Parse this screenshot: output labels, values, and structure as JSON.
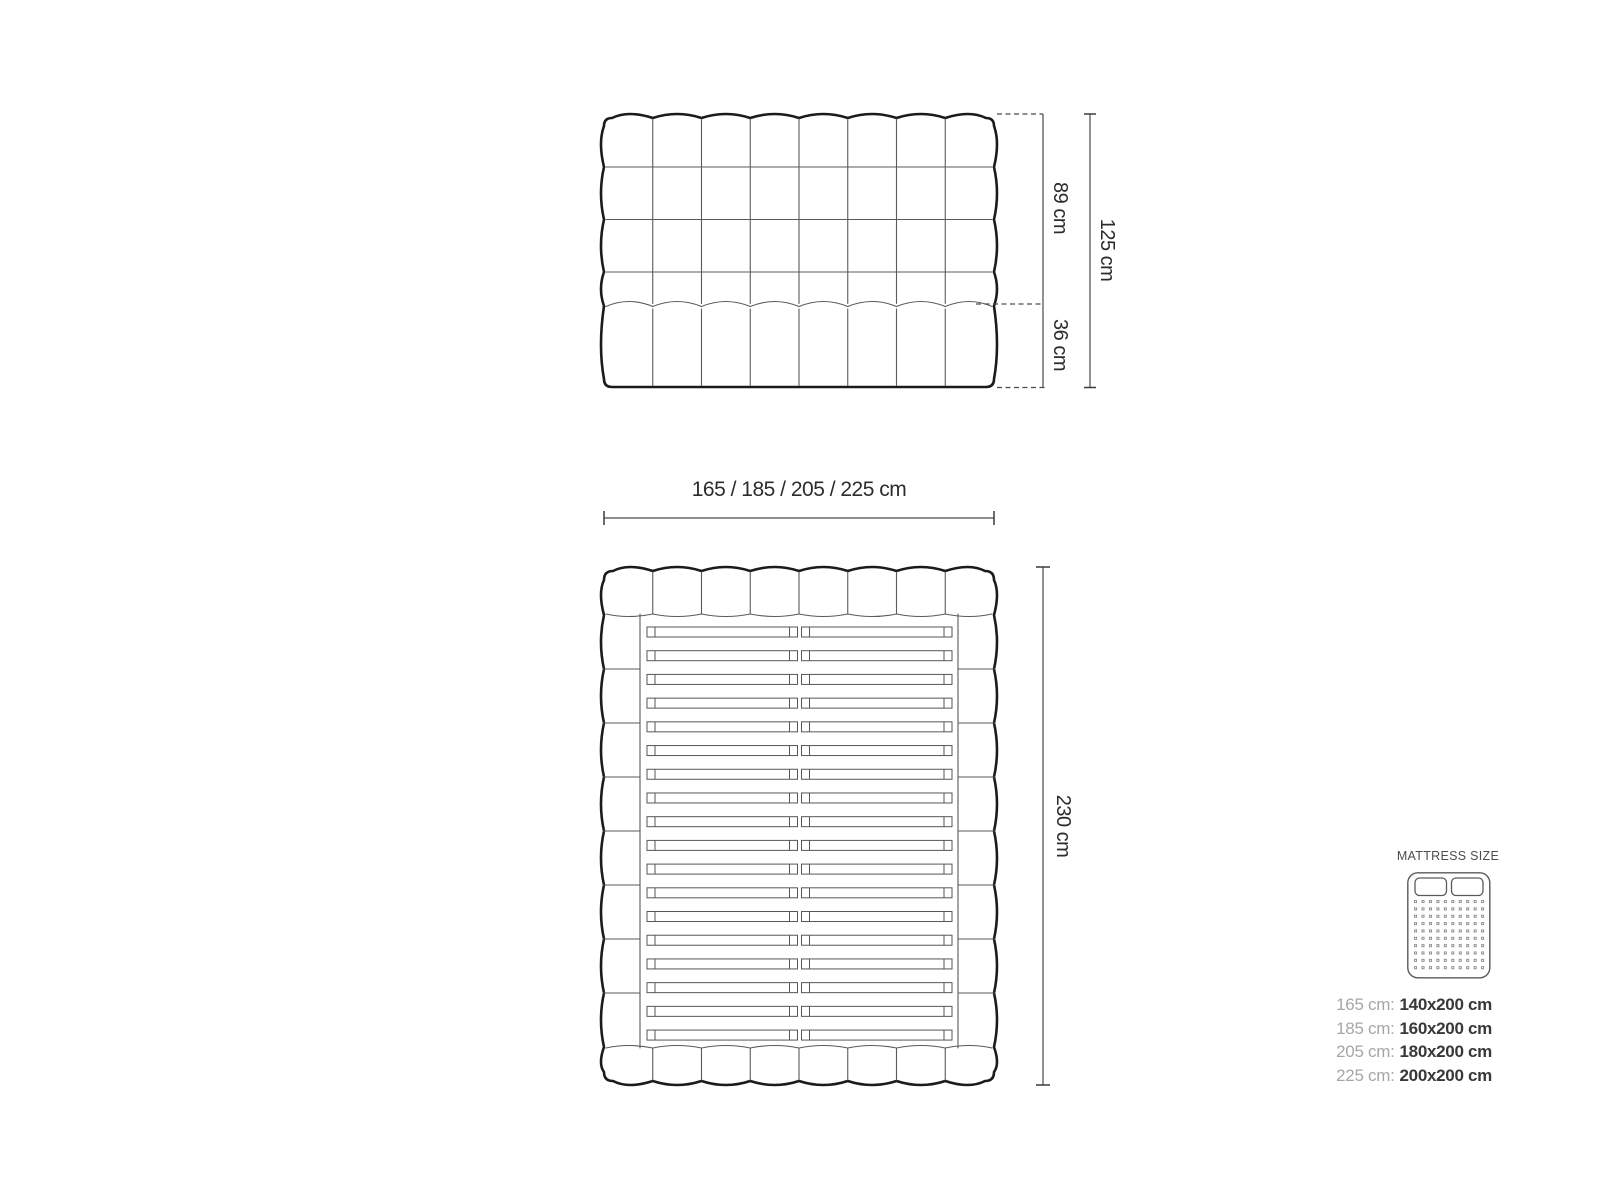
{
  "figure": {
    "type": "bed-dimension-diagram",
    "headboard_front": {
      "columns": 8,
      "tuft_rows_upper": 4,
      "tuft_rows_lower": 1
    },
    "bed_top": {
      "columns": 8,
      "side_segments": 8,
      "slat_rows": 18,
      "slats_per_row": 2
    },
    "legend_icon": {
      "dot_rows": 10,
      "dot_cols": 10,
      "pillows": 2
    }
  },
  "dimensions": {
    "headboard_upper": "89 cm",
    "headboard_lower": "36 cm",
    "headboard_total": "125 cm",
    "width_options": "165 / 185 / 205 / 225 cm",
    "length_total": "230 cm"
  },
  "legend": {
    "title": "MATTRESS SIZE",
    "rows": [
      {
        "label": "165 cm:",
        "value": "140x200 cm"
      },
      {
        "label": "185 cm:",
        "value": "160x200 cm"
      },
      {
        "label": "205 cm:",
        "value": "180x200 cm"
      },
      {
        "label": "225 cm:",
        "value": "200x200 cm"
      }
    ]
  },
  "colors": {
    "background": "#ffffff",
    "outline_bold": "#1b1b1b",
    "line_thin": "#555555",
    "dimension_line": "#4a4a4a",
    "dimension_text": "#2c2c2c",
    "legend_label_muted": "#a6a6a6",
    "legend_value_dark": "#383838",
    "dot_gray": "#8a8a8a"
  }
}
